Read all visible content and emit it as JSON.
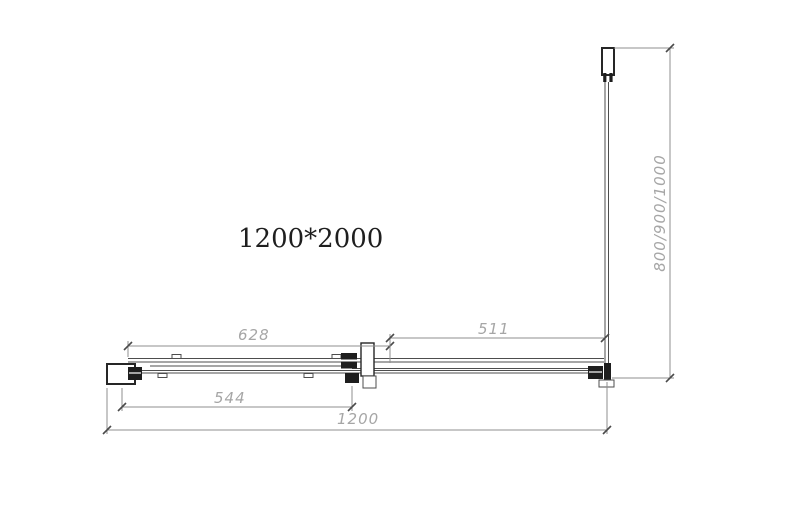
{
  "title": {
    "text": "1200*2000"
  },
  "dimensions": {
    "fixed_panel_width": "628",
    "door_width": "544",
    "side_clear_width": "511",
    "total_width": "1200",
    "side_depth_options": "800/900/1000"
  },
  "colors": {
    "bg": "#ffffff",
    "line": "#4d4d4d",
    "heavy-line": "#262626",
    "dark-fill": "#1e1e1e",
    "dim-line": "#8f8f8f",
    "dim-text": "#a6a6a6",
    "title-text": "#1f1f1f"
  }
}
